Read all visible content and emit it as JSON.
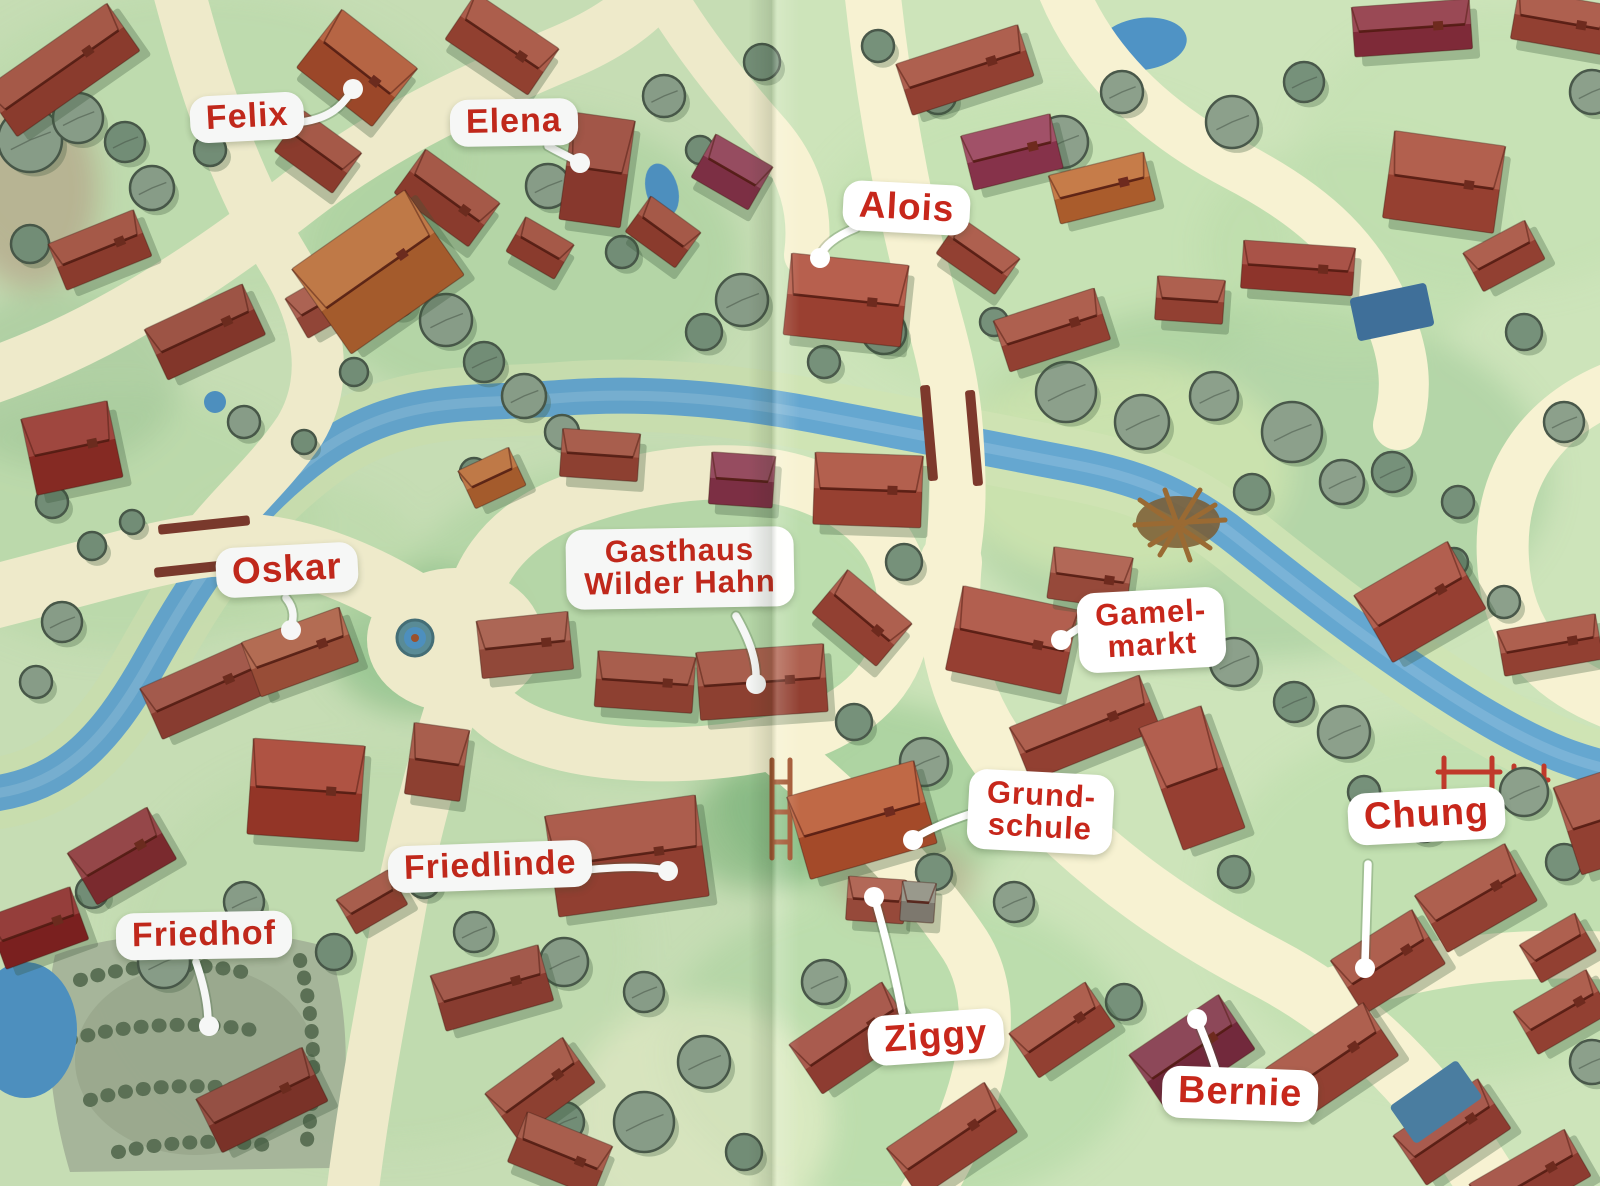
{
  "labels": {
    "felix": {
      "text": "Felix"
    },
    "elena": {
      "text": "Elena"
    },
    "alois": {
      "text": "Alois"
    },
    "oskar": {
      "text": "Oskar"
    },
    "gasthaus": {
      "line1": "Gasthaus",
      "line2": "Wilder Hahn"
    },
    "gamelmarkt": {
      "line1": "Gamel-",
      "line2": "markt"
    },
    "grundschule": {
      "line1": "Grund-",
      "line2": "schule"
    },
    "chung": {
      "text": "Chung"
    },
    "friedlinde": {
      "text": "Friedlinde"
    },
    "friedhof": {
      "text": "Friedhof"
    },
    "ziggy": {
      "text": "Ziggy"
    },
    "bernie": {
      "text": "Bernie"
    }
  },
  "colors": {
    "label_text": "#c7271b",
    "label_bubble": "#ffffff",
    "pointer_line": "#ffffff",
    "road": "#f7f2d2",
    "river": "#65a7d0",
    "river_bank": "#cfe3b4",
    "grass": "#cde4ba",
    "tree": "#8ca08b",
    "tree_dark": "#76917a",
    "tree_outline": "#49584a",
    "house_red": "#a34a3a",
    "house_maroon": "#8e3550",
    "house_orange": "#bf6a33",
    "bridge": "#7d392c",
    "pond": "#4f93c5",
    "cemetery": "#aab79d",
    "hedge": "#5d7257"
  }
}
